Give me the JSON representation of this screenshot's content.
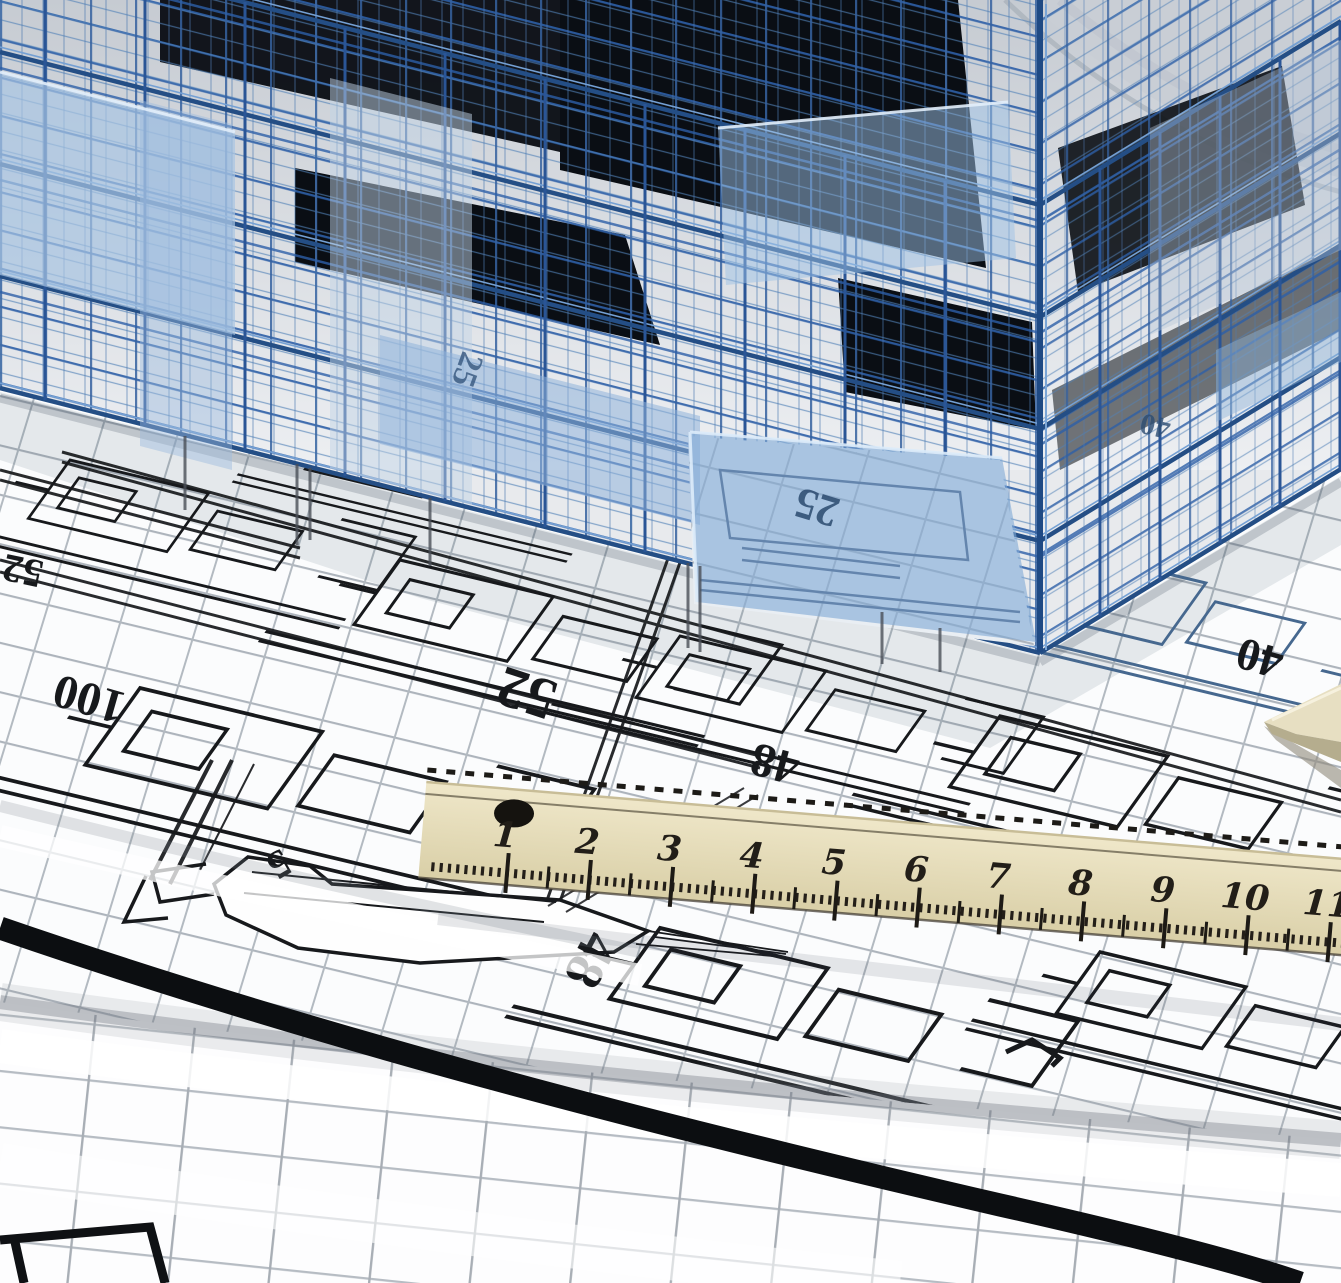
{
  "scene": {
    "description": "3D blue wireframe building model standing on rolled architectural blueprint sheets, with a wooden scale ruler and a set square lying on the plans"
  },
  "blueprint": {
    "labels": [
      "52",
      "100",
      "52",
      "48",
      "5",
      "48",
      "40",
      "25",
      "40",
      "25"
    ]
  },
  "ruler": {
    "units": [
      "1",
      "2",
      "3",
      "4",
      "5",
      "6",
      "7",
      "8",
      "9",
      "10",
      "11"
    ]
  },
  "colors": {
    "wireframe_blue": "#2d5fa7",
    "glass_panel_blue": "#7fa9d6",
    "window_dark": "#0a0e14",
    "paper_white": "#fbfcfd",
    "grid_gray": "#adb4bc",
    "plan_line_black": "#17191c",
    "ruler_wood_beige": "#e6dcba",
    "ruler_marking_black": "#221e18"
  }
}
